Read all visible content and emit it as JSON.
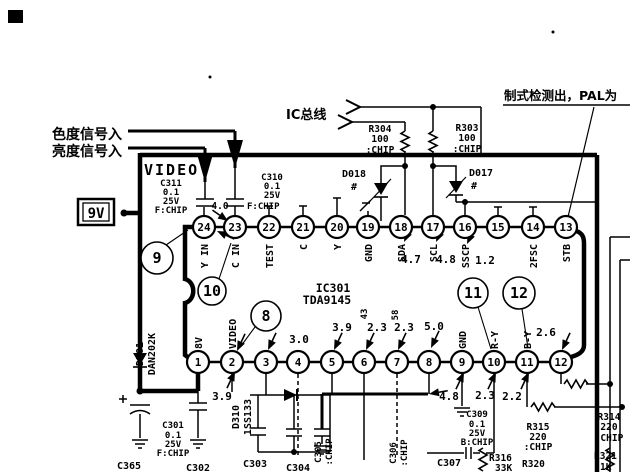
{
  "annotations": {
    "chroma_input": "色度信号入",
    "luma_input": "亮度信号入",
    "ic_bus_label": "IC总线",
    "standard_detect_note": "制式检测出，PAL为",
    "video_label": "VIDEO",
    "supply_label": "9V"
  },
  "ic": {
    "ref": "IC301",
    "part": "TDA9145",
    "top_pins": [
      {
        "num": "24",
        "name": "Y IN",
        "x": 204
      },
      {
        "num": "23",
        "name": "C IN",
        "x": 235
      },
      {
        "num": "22",
        "name": "TEST",
        "x": 269
      },
      {
        "num": "21",
        "name": "C",
        "x": 303
      },
      {
        "num": "20",
        "name": "Y",
        "x": 337
      },
      {
        "num": "19",
        "name": "GND",
        "x": 368
      },
      {
        "num": "18",
        "name": "SDA",
        "x": 401
      },
      {
        "num": "17",
        "name": "SCL",
        "x": 433
      },
      {
        "num": "16",
        "name": "SSCP",
        "x": 465
      },
      {
        "num": "15",
        "name": "",
        "x": 498
      },
      {
        "num": "14",
        "name": "2FSC",
        "x": 533
      },
      {
        "num": "13",
        "name": "STB",
        "x": 566
      }
    ],
    "bottom_pins": [
      {
        "num": "1",
        "name": "8V",
        "x": 198
      },
      {
        "num": "2",
        "name": "VIDEO",
        "x": 232
      },
      {
        "num": "3",
        "name": "",
        "x": 266
      },
      {
        "num": "4",
        "name": "",
        "x": 298
      },
      {
        "num": "5",
        "name": "",
        "x": 332
      },
      {
        "num": "6",
        "name": "",
        "x": 364
      },
      {
        "num": "7",
        "name": "",
        "x": 397
      },
      {
        "num": "8",
        "name": "",
        "x": 429
      },
      {
        "num": "9",
        "name": "GND",
        "x": 462
      },
      {
        "num": "10",
        "name": "R-Y",
        "x": 494
      },
      {
        "num": "11",
        "name": "B-Y",
        "x": 527
      },
      {
        "num": "12",
        "name": "",
        "x": 561
      }
    ]
  },
  "callouts": [
    {
      "label": "9",
      "cx": 157,
      "cy": 258,
      "r": 16,
      "lx1": 166,
      "ly1": 245,
      "lx2": 188,
      "ly2": 230
    },
    {
      "label": "10",
      "cx": 212,
      "cy": 291,
      "r": 14,
      "lx1": 219,
      "ly1": 279,
      "lx2": 231,
      "ly2": 243
    },
    {
      "label": "8",
      "cx": 266,
      "cy": 316,
      "r": 15,
      "lx1": 255,
      "ly1": 327,
      "lx2": 241,
      "ly2": 346
    },
    {
      "label": "11",
      "cx": 473,
      "cy": 293,
      "r": 15,
      "lx1": 478,
      "ly1": 307,
      "lx2": 491,
      "ly2": 349
    },
    {
      "label": "12",
      "cx": 519,
      "cy": 293,
      "r": 16,
      "lx1": 522,
      "ly1": 309,
      "lx2": 528,
      "ly2": 348
    }
  ],
  "voltages": [
    {
      "t": "4.0",
      "x": 220,
      "y": 209,
      "s": 9.5
    },
    {
      "t": "4.7",
      "x": 411,
      "y": 263
    },
    {
      "t": "4.8",
      "x": 446,
      "y": 263
    },
    {
      "t": "1.2",
      "x": 485,
      "y": 264
    },
    {
      "t": "3.9",
      "x": 222,
      "y": 400
    },
    {
      "t": "3.0",
      "x": 299,
      "y": 343
    },
    {
      "t": "3.9",
      "x": 342,
      "y": 331
    },
    {
      "t": "2.3",
      "x": 377,
      "y": 331
    },
    {
      "t": "2.3",
      "x": 404,
      "y": 331
    },
    {
      "t": "5.0",
      "x": 434,
      "y": 330
    },
    {
      "t": "2.6",
      "x": 546,
      "y": 336
    },
    {
      "t": "4.8",
      "x": 449,
      "y": 400
    },
    {
      "t": "2.3",
      "x": 485,
      "y": 399
    },
    {
      "t": "2.2",
      "x": 512,
      "y": 400
    },
    {
      "t": "43",
      "x": 367,
      "y": 314,
      "rot": -90,
      "s": 9
    },
    {
      "t": "58",
      "x": 398,
      "y": 315,
      "rot": -90,
      "s": 9
    }
  ],
  "components": {
    "c311": {
      "lines": [
        "C311",
        "0.1",
        "25V",
        "F:CHIP"
      ]
    },
    "c310": {
      "lines": [
        "C310",
        "0.1",
        "25V"
      ]
    },
    "c310_chip": "F:CHIP",
    "r304": {
      "lines": [
        "R304",
        "100",
        ":CHIP"
      ]
    },
    "r303": {
      "lines": [
        "R303",
        "100",
        ":CHIP"
      ]
    },
    "d018": {
      "ref": "D018",
      "mark": "#"
    },
    "d017": {
      "ref": "D017",
      "mark": "#"
    },
    "d301": {
      "ref": "D301",
      "part": "DAN202K"
    },
    "d310": {
      "ref": "D310",
      "part": "1SS133"
    },
    "c301": {
      "lines": [
        "C301",
        "0.1",
        "25V",
        "F:CHIP"
      ]
    },
    "c365": "C365",
    "c302": "C302",
    "c303": "C303",
    "c304": "C304",
    "c305": {
      "ref": "C305",
      "chip": ":CHIP"
    },
    "c306": {
      "ref": "C306",
      "chip": ":CHIP"
    },
    "c307": "C307",
    "c309": {
      "lines": [
        "C309",
        "0.1",
        "25V",
        "B:CHIP"
      ]
    },
    "r315": {
      "lines": [
        "R315",
        "220",
        ":CHIP"
      ]
    },
    "r316": {
      "lines": [
        "R316",
        "33K"
      ]
    },
    "r320": "R320",
    "r314": {
      "lines": [
        "R314",
        "220",
        ":CHIP"
      ]
    },
    "r321": {
      "lines": [
        "R321",
        "1K"
      ]
    }
  }
}
